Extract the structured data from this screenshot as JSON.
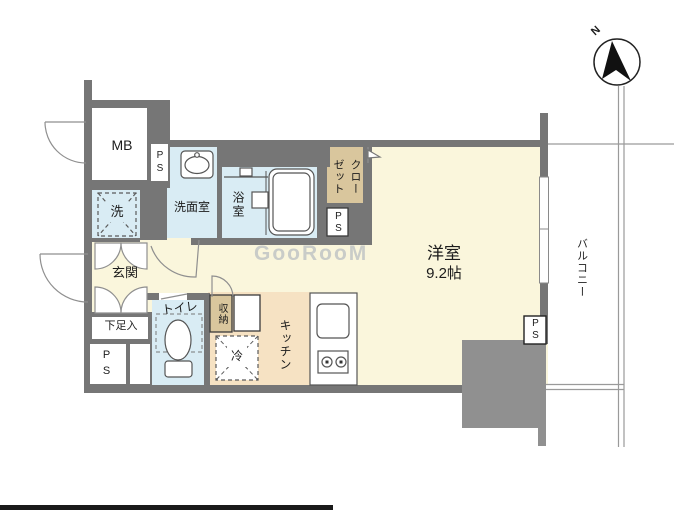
{
  "floorplan": {
    "watermark": "GooRooM",
    "compass": {
      "north": "N"
    },
    "labels": {
      "mb": "MB",
      "ps": "PS",
      "washer": "洗",
      "powder_room": "洗面室",
      "bathroom": "浴室",
      "closet": "クロー\nゼット",
      "entrance": "玄関",
      "shoe_cabinet": "下足入",
      "toilet": "トイレ",
      "storage": "収納",
      "refrigerator": "冷",
      "kitchen": "キッチン",
      "main_room": "洋室",
      "main_room_size": "9.2帖",
      "balcony": "バルコニー"
    },
    "colors": {
      "wall": "#767676",
      "column": "#909090",
      "room_cream": "#faf6dc",
      "kitchen_peach": "#f6e2c3",
      "wet_blue": "#d9ecf4",
      "closet_tan": "#d9c69d"
    }
  }
}
